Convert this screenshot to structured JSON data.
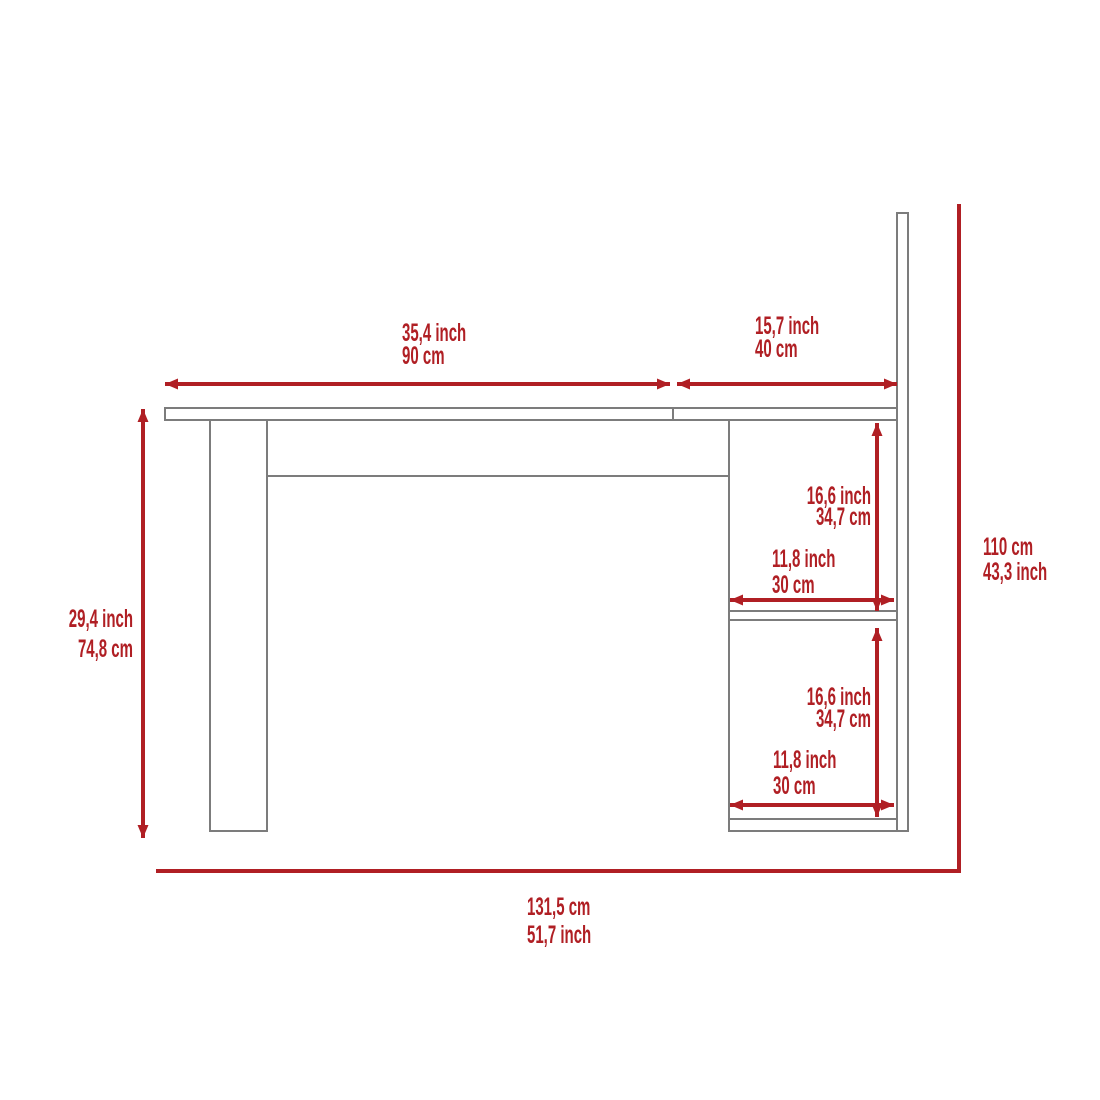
{
  "colors": {
    "dimension_red": "#b01f24",
    "furniture_line_gray": "#7c7c7c",
    "background": "#ffffff"
  },
  "labels": {
    "desktop_main_width": {
      "line1": "35,4 inch",
      "line2": "90 cm"
    },
    "desktop_side_width": {
      "line1": "15,7 inch",
      "line2": "40 cm"
    },
    "desk_height": {
      "line1": "29,4 inch",
      "line2": "74,8 cm"
    },
    "overall_height": {
      "line1": "110 cm",
      "line2": "43,3 inch"
    },
    "overall_width": {
      "line1": "131,5 cm",
      "line2": "51,7 inch"
    },
    "upper_shelf_height": {
      "line1": "16,6 inch",
      "line2": "34,7 cm"
    },
    "upper_shelf_width": {
      "line1": "11,8 inch",
      "line2": "30 cm"
    },
    "lower_shelf_height": {
      "line1": "16,6 inch",
      "line2": "34,7 cm"
    },
    "lower_shelf_width": {
      "line1": "11,8 inch",
      "line2": "30 cm"
    }
  }
}
